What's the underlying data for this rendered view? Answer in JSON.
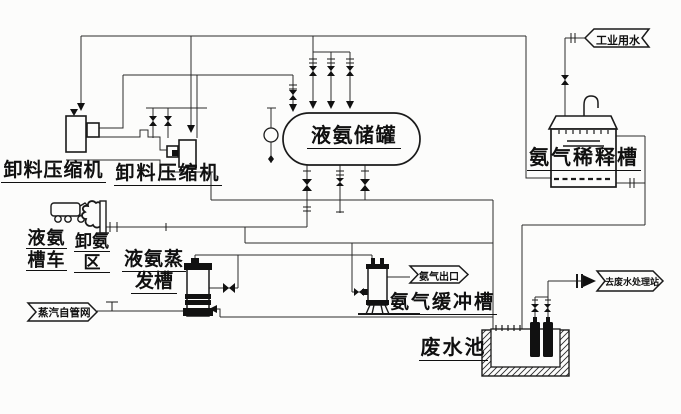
{
  "colors": {
    "line": "#2b2b2b",
    "equipment": "#1a1a1a",
    "text": "#101010",
    "background": "#fcfcfb"
  },
  "labels": {
    "compressor_left": {
      "text": "卸料压缩机"
    },
    "compressor_right": {
      "text": "卸料压缩机"
    },
    "tank_truck": {
      "line1": "液氨",
      "line2": "槽车"
    },
    "unloading_area": {
      "line1": "卸氨",
      "line2": "区"
    },
    "evaporator": {
      "line1": "液氨蒸",
      "line2": "发槽"
    },
    "storage_tank": {
      "text": "液氨储罐"
    },
    "dilution_tank": {
      "text": "氨气稀释槽"
    },
    "buffer_tank": {
      "text": "氨气缓冲槽"
    },
    "waste_pool": {
      "text": "废水池"
    }
  },
  "flow_tags": {
    "industrial_water": "工业用水",
    "steam_supply": "蒸汽自管网",
    "ammonia_outlet": "氨气出口",
    "to_wastewater": "去废水处理站"
  }
}
